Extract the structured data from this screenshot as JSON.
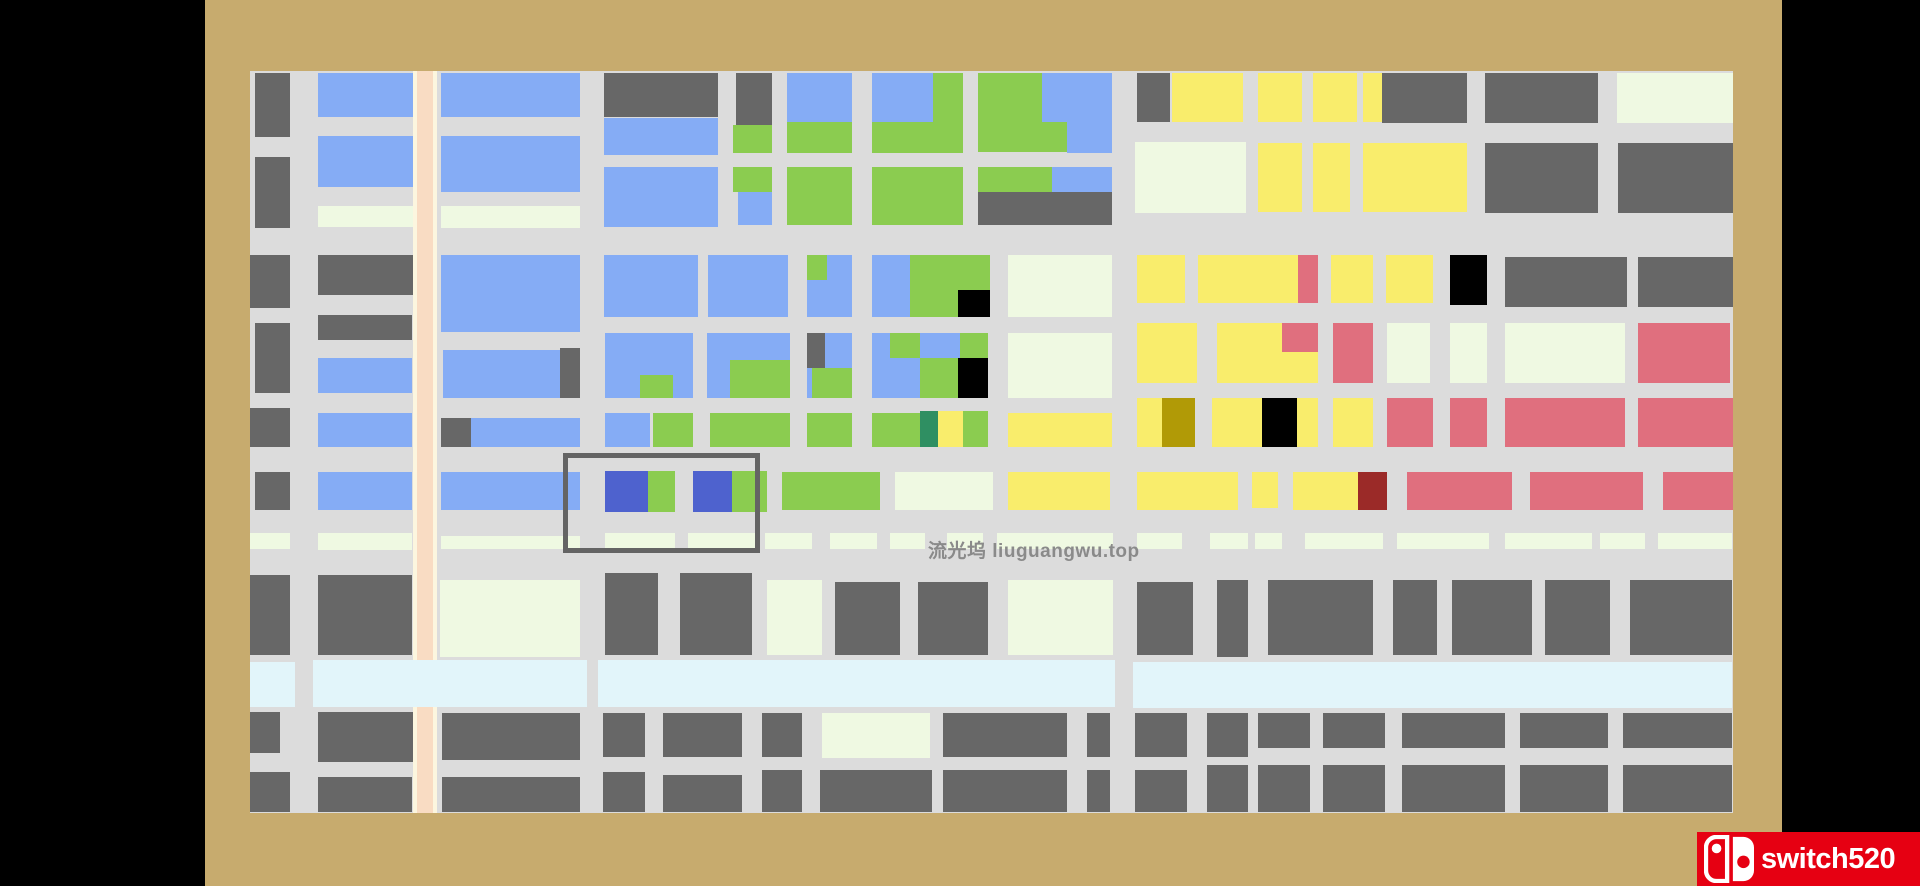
{
  "scene": {
    "description": "top-down city block puzzle map on a tan table with letterbox bars",
    "background_color": "#000000",
    "frame_color": "#C7AB6E",
    "street_color": "#DCDCDC"
  },
  "palette": {
    "dk": "#676767",
    "bl": "#85ACF5",
    "gr": "#8BCC50",
    "yl": "#F9ED6C",
    "cr": "#EFF9E2",
    "pk": "#E06F7E",
    "rv": "#E2F5FA",
    "ry": "#4E62CE",
    "tl": "#2F8F62",
    "ol": "#B19A06",
    "mr": "#9B2A28",
    "bk": "#000000"
  },
  "board": {
    "x": 250,
    "y": 71,
    "w": 1483,
    "h": 742,
    "road": {
      "x": 413,
      "w": 24,
      "edge_color": "#FCF6DF",
      "center_color": "#F9DCC3"
    },
    "blocks": [
      [
        255,
        73,
        35,
        64,
        "dk"
      ],
      [
        255,
        157,
        35,
        71,
        "dk"
      ],
      [
        250,
        255,
        40,
        53,
        "dk"
      ],
      [
        255,
        323,
        35,
        70,
        "dk"
      ],
      [
        250,
        408,
        40,
        39,
        "dk"
      ],
      [
        255,
        472,
        35,
        38,
        "dk"
      ],
      [
        250,
        533,
        40,
        16,
        "cr"
      ],
      [
        250,
        575,
        40,
        80,
        "dk"
      ],
      [
        250,
        712,
        30,
        41,
        "dk"
      ],
      [
        250,
        772,
        40,
        40,
        "dk"
      ],
      [
        318,
        73,
        95,
        44,
        "bl"
      ],
      [
        318,
        136,
        95,
        51,
        "bl"
      ],
      [
        318,
        206,
        95,
        21,
        "cr"
      ],
      [
        318,
        255,
        95,
        40,
        "dk"
      ],
      [
        318,
        315,
        94,
        25,
        "dk"
      ],
      [
        318,
        358,
        94,
        35,
        "bl"
      ],
      [
        318,
        413,
        94,
        34,
        "bl"
      ],
      [
        318,
        472,
        94,
        38,
        "bl"
      ],
      [
        318,
        533,
        94,
        17,
        "cr"
      ],
      [
        318,
        575,
        94,
        80,
        "dk"
      ],
      [
        318,
        712,
        95,
        50,
        "dk"
      ],
      [
        318,
        777,
        94,
        35,
        "dk"
      ],
      [
        441,
        73,
        139,
        44,
        "bl"
      ],
      [
        441,
        136,
        139,
        56,
        "bl"
      ],
      [
        441,
        206,
        139,
        22,
        "cr"
      ],
      [
        441,
        255,
        139,
        77,
        "bl"
      ],
      [
        443,
        350,
        137,
        48,
        "bl"
      ],
      [
        560,
        348,
        20,
        50,
        "dk"
      ],
      [
        441,
        418,
        30,
        29,
        "dk"
      ],
      [
        471,
        418,
        109,
        29,
        "bl"
      ],
      [
        441,
        472,
        139,
        38,
        "bl"
      ],
      [
        441,
        536,
        139,
        13,
        "cr"
      ],
      [
        440,
        580,
        140,
        77,
        "cr"
      ],
      [
        442,
        713,
        138,
        47,
        "dk"
      ],
      [
        442,
        777,
        138,
        35,
        "dk"
      ],
      [
        604,
        73,
        114,
        44,
        "dk"
      ],
      [
        604,
        118,
        114,
        37,
        "bl"
      ],
      [
        604,
        167,
        114,
        60,
        "bl"
      ],
      [
        604,
        255,
        94,
        62,
        "bl"
      ],
      [
        708,
        255,
        80,
        62,
        "bl"
      ],
      [
        605,
        333,
        88,
        65,
        "bl"
      ],
      [
        640,
        375,
        33,
        23,
        "gr"
      ],
      [
        707,
        333,
        83,
        65,
        "bl"
      ],
      [
        730,
        360,
        60,
        38,
        "gr"
      ],
      [
        605,
        413,
        45,
        34,
        "bl"
      ],
      [
        653,
        413,
        40,
        34,
        "gr"
      ],
      [
        710,
        413,
        80,
        34,
        "gr"
      ],
      [
        605,
        471,
        43,
        41,
        "ry"
      ],
      [
        648,
        471,
        27,
        41,
        "gr"
      ],
      [
        693,
        471,
        39,
        41,
        "ry"
      ],
      [
        732,
        471,
        35,
        41,
        "gr"
      ],
      [
        605,
        533,
        70,
        16,
        "cr"
      ],
      [
        688,
        533,
        72,
        16,
        "cr"
      ],
      [
        765,
        533,
        47,
        16,
        "cr"
      ],
      [
        605,
        573,
        53,
        82,
        "dk"
      ],
      [
        680,
        573,
        72,
        82,
        "dk"
      ],
      [
        603,
        713,
        42,
        44,
        "dk"
      ],
      [
        663,
        713,
        79,
        44,
        "dk"
      ],
      [
        603,
        772,
        42,
        40,
        "dk"
      ],
      [
        663,
        775,
        79,
        37,
        "dk"
      ],
      [
        736,
        73,
        36,
        52,
        "dk"
      ],
      [
        733,
        125,
        39,
        28,
        "gr"
      ],
      [
        787,
        73,
        65,
        49,
        "bl"
      ],
      [
        787,
        122,
        65,
        31,
        "gr"
      ],
      [
        872,
        73,
        91,
        80,
        "gr"
      ],
      [
        872,
        73,
        61,
        49,
        "bl"
      ],
      [
        978,
        73,
        134,
        79,
        "gr"
      ],
      [
        1042,
        73,
        70,
        49,
        "bl"
      ],
      [
        1067,
        122,
        45,
        31,
        "bl"
      ],
      [
        733,
        167,
        39,
        25,
        "gr"
      ],
      [
        738,
        192,
        34,
        33,
        "bl"
      ],
      [
        787,
        167,
        65,
        58,
        "gr"
      ],
      [
        872,
        167,
        91,
        58,
        "gr"
      ],
      [
        978,
        167,
        74,
        25,
        "gr"
      ],
      [
        1052,
        167,
        60,
        25,
        "bl"
      ],
      [
        978,
        192,
        134,
        33,
        "dk"
      ],
      [
        807,
        255,
        45,
        62,
        "bl"
      ],
      [
        807,
        255,
        20,
        25,
        "gr"
      ],
      [
        872,
        255,
        41,
        62,
        "bl"
      ],
      [
        910,
        255,
        80,
        62,
        "gr"
      ],
      [
        958,
        290,
        32,
        27,
        "bk"
      ],
      [
        1008,
        255,
        104,
        62,
        "cr"
      ],
      [
        807,
        333,
        45,
        65,
        "bl"
      ],
      [
        807,
        333,
        18,
        35,
        "dk"
      ],
      [
        812,
        368,
        40,
        30,
        "gr"
      ],
      [
        872,
        333,
        116,
        65,
        "bl"
      ],
      [
        890,
        333,
        30,
        25,
        "gr"
      ],
      [
        960,
        333,
        28,
        25,
        "gr"
      ],
      [
        920,
        358,
        38,
        40,
        "gr"
      ],
      [
        958,
        358,
        30,
        40,
        "bk"
      ],
      [
        1008,
        333,
        104,
        65,
        "cr"
      ],
      [
        807,
        413,
        45,
        34,
        "gr"
      ],
      [
        872,
        413,
        48,
        34,
        "gr"
      ],
      [
        920,
        411,
        18,
        36,
        "tl"
      ],
      [
        938,
        411,
        25,
        36,
        "yl"
      ],
      [
        963,
        411,
        25,
        36,
        "gr"
      ],
      [
        1008,
        413,
        104,
        34,
        "yl"
      ],
      [
        782,
        472,
        98,
        38,
        "gr"
      ],
      [
        895,
        472,
        98,
        38,
        "cr"
      ],
      [
        1008,
        472,
        102,
        38,
        "yl"
      ],
      [
        830,
        533,
        47,
        16,
        "cr"
      ],
      [
        890,
        533,
        35,
        16,
        "cr"
      ],
      [
        947,
        533,
        36,
        16,
        "cr"
      ],
      [
        997,
        533,
        116,
        16,
        "cr"
      ],
      [
        1137,
        73,
        33,
        49,
        "dk"
      ],
      [
        1172,
        73,
        71,
        49,
        "yl"
      ],
      [
        1258,
        73,
        44,
        49,
        "yl"
      ],
      [
        1313,
        73,
        44,
        49,
        "yl"
      ],
      [
        1363,
        73,
        19,
        49,
        "yl"
      ],
      [
        1382,
        73,
        85,
        50,
        "dk"
      ],
      [
        1485,
        73,
        113,
        50,
        "dk"
      ],
      [
        1617,
        73,
        116,
        50,
        "cr"
      ],
      [
        1135,
        142,
        111,
        71,
        "cr"
      ],
      [
        1258,
        143,
        44,
        69,
        "yl"
      ],
      [
        1313,
        143,
        37,
        69,
        "yl"
      ],
      [
        1363,
        143,
        104,
        69,
        "yl"
      ],
      [
        1485,
        143,
        113,
        70,
        "dk"
      ],
      [
        1618,
        143,
        115,
        70,
        "dk"
      ],
      [
        1137,
        255,
        48,
        48,
        "yl"
      ],
      [
        1198,
        255,
        100,
        48,
        "yl"
      ],
      [
        1298,
        255,
        20,
        48,
        "pk"
      ],
      [
        1331,
        255,
        42,
        48,
        "yl"
      ],
      [
        1386,
        255,
        47,
        48,
        "yl"
      ],
      [
        1450,
        255,
        37,
        50,
        "bk"
      ],
      [
        1505,
        257,
        122,
        50,
        "dk"
      ],
      [
        1638,
        257,
        95,
        50,
        "dk"
      ],
      [
        1137,
        323,
        60,
        60,
        "yl"
      ],
      [
        1217,
        323,
        101,
        60,
        "yl"
      ],
      [
        1282,
        323,
        36,
        29,
        "pk"
      ],
      [
        1333,
        323,
        40,
        60,
        "pk"
      ],
      [
        1387,
        323,
        43,
        60,
        "cr"
      ],
      [
        1450,
        323,
        37,
        60,
        "cr"
      ],
      [
        1505,
        323,
        120,
        60,
        "cr"
      ],
      [
        1638,
        323,
        92,
        60,
        "pk"
      ],
      [
        1137,
        398,
        25,
        49,
        "yl"
      ],
      [
        1162,
        398,
        33,
        49,
        "ol"
      ],
      [
        1212,
        398,
        50,
        49,
        "yl"
      ],
      [
        1262,
        398,
        35,
        49,
        "bk"
      ],
      [
        1297,
        398,
        21,
        49,
        "yl"
      ],
      [
        1333,
        398,
        40,
        49,
        "yl"
      ],
      [
        1387,
        398,
        46,
        49,
        "pk"
      ],
      [
        1450,
        398,
        37,
        49,
        "pk"
      ],
      [
        1505,
        398,
        120,
        49,
        "pk"
      ],
      [
        1638,
        398,
        95,
        49,
        "pk"
      ],
      [
        1137,
        472,
        101,
        38,
        "yl"
      ],
      [
        1252,
        472,
        26,
        36,
        "yl"
      ],
      [
        1293,
        472,
        65,
        38,
        "yl"
      ],
      [
        1358,
        472,
        29,
        38,
        "mr"
      ],
      [
        1407,
        472,
        105,
        38,
        "pk"
      ],
      [
        1530,
        472,
        113,
        38,
        "pk"
      ],
      [
        1663,
        472,
        70,
        38,
        "pk"
      ],
      [
        1137,
        533,
        45,
        16,
        "cr"
      ],
      [
        1210,
        533,
        38,
        16,
        "cr"
      ],
      [
        1255,
        533,
        27,
        16,
        "cr"
      ],
      [
        1305,
        533,
        78,
        16,
        "cr"
      ],
      [
        1397,
        533,
        92,
        16,
        "cr"
      ],
      [
        1505,
        533,
        87,
        16,
        "cr"
      ],
      [
        1600,
        533,
        45,
        16,
        "cr"
      ],
      [
        1658,
        533,
        74,
        16,
        "cr"
      ],
      [
        767,
        580,
        55,
        75,
        "cr"
      ],
      [
        835,
        582,
        65,
        73,
        "dk"
      ],
      [
        918,
        582,
        70,
        73,
        "dk"
      ],
      [
        1008,
        580,
        105,
        75,
        "cr"
      ],
      [
        1137,
        582,
        56,
        73,
        "dk"
      ],
      [
        1217,
        580,
        31,
        77,
        "dk"
      ],
      [
        1268,
        580,
        105,
        75,
        "dk"
      ],
      [
        1393,
        580,
        44,
        75,
        "dk"
      ],
      [
        1452,
        580,
        80,
        75,
        "dk"
      ],
      [
        1545,
        580,
        65,
        75,
        "dk"
      ],
      [
        1630,
        580,
        102,
        75,
        "dk"
      ],
      [
        250,
        662,
        45,
        45,
        "rv"
      ],
      [
        313,
        660,
        274,
        47,
        "rv"
      ],
      [
        598,
        660,
        517,
        47,
        "rv"
      ],
      [
        1133,
        662,
        599,
        46,
        "rv"
      ],
      [
        762,
        713,
        40,
        44,
        "dk"
      ],
      [
        822,
        713,
        108,
        45,
        "cr"
      ],
      [
        943,
        713,
        124,
        44,
        "dk"
      ],
      [
        1087,
        713,
        23,
        44,
        "dk"
      ],
      [
        1135,
        713,
        52,
        44,
        "dk"
      ],
      [
        1207,
        713,
        41,
        44,
        "dk"
      ],
      [
        1258,
        713,
        52,
        35,
        "dk"
      ],
      [
        1323,
        713,
        62,
        35,
        "dk"
      ],
      [
        1402,
        713,
        103,
        35,
        "dk"
      ],
      [
        1520,
        713,
        88,
        35,
        "dk"
      ],
      [
        1623,
        713,
        109,
        35,
        "dk"
      ],
      [
        762,
        770,
        40,
        42,
        "dk"
      ],
      [
        820,
        770,
        112,
        42,
        "dk"
      ],
      [
        943,
        770,
        124,
        42,
        "dk"
      ],
      [
        1087,
        770,
        23,
        42,
        "dk"
      ],
      [
        1135,
        770,
        52,
        42,
        "dk"
      ],
      [
        1207,
        765,
        41,
        47,
        "dk"
      ],
      [
        1258,
        765,
        52,
        47,
        "dk"
      ],
      [
        1323,
        765,
        62,
        47,
        "dk"
      ],
      [
        1402,
        765,
        103,
        47,
        "dk"
      ],
      [
        1520,
        765,
        88,
        47,
        "dk"
      ],
      [
        1623,
        765,
        109,
        47,
        "dk"
      ]
    ]
  },
  "selection": {
    "x": 563,
    "y": 453,
    "w": 197,
    "h": 100,
    "stroke_color": "#646464"
  },
  "watermark": {
    "text": "流光坞 liuguangwu.top",
    "x": 928,
    "y": 536,
    "color": "#8A8A8A"
  },
  "badge": {
    "text": "switch520",
    "background_color": "#E60012",
    "text_color": "#FFFFFF"
  }
}
